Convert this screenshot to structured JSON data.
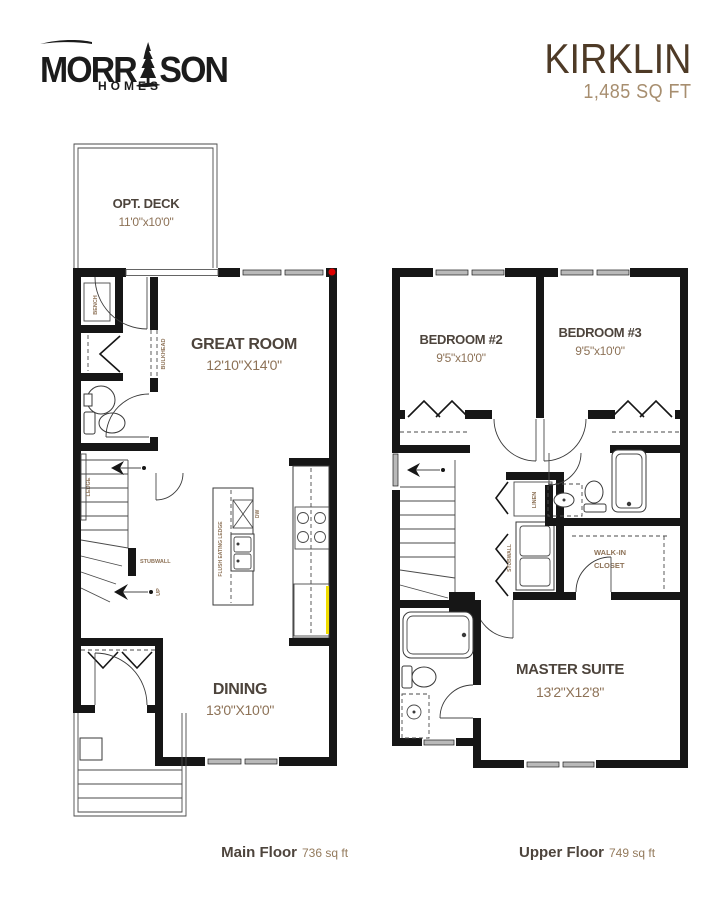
{
  "header": {
    "logo_part1": "MORR",
    "logo_part2": "SON",
    "logo_sub": "HOMES",
    "plan_name": "KIRKLIN",
    "plan_sqft": "1,485 SQ FT"
  },
  "colors": {
    "label_dark": "#4d443c",
    "label_brown": "#8d7257",
    "title_brown": "#4e3a26",
    "subtitle_tan": "#a78e6f",
    "wall_black": "#161616",
    "accent_red": "#dd0000",
    "accent_yellow": "#f0dc00"
  },
  "main_floor": {
    "caption_title": "Main Floor",
    "caption_sqft": "736 sq ft",
    "deck_name": "OPT. DECK",
    "deck_dims": "11'0\"x10'0\"",
    "great_room_name": "GREAT ROOM",
    "great_room_dims": "12'10\"X14'0\"",
    "dining_name": "DINING",
    "dining_dims": "13'0\"X10'0\"",
    "bench": "BENCH",
    "bulkhead": "BULKHEAD",
    "ledge": "LEDGE",
    "stubwall": "STUBWALL",
    "up": "UP",
    "flush_eating_ledge": "FLUSH EATING LEDGE",
    "dw": "DW"
  },
  "upper_floor": {
    "caption_title": "Upper Floor",
    "caption_sqft": "749 sq ft",
    "bedroom2_name": "BEDROOM #2",
    "bedroom2_dims": "9'5\"x10'0\"",
    "bedroom3_name": "BEDROOM #3",
    "bedroom3_dims": "9'5\"x10'0\"",
    "master_name": "MASTER SUITE",
    "master_dims": "13'2\"X12'8\"",
    "linen": "LINEN",
    "stubwall": "STUBWALL",
    "walk_in_line1": "WALK-IN",
    "walk_in_line2": "CLOSET"
  }
}
